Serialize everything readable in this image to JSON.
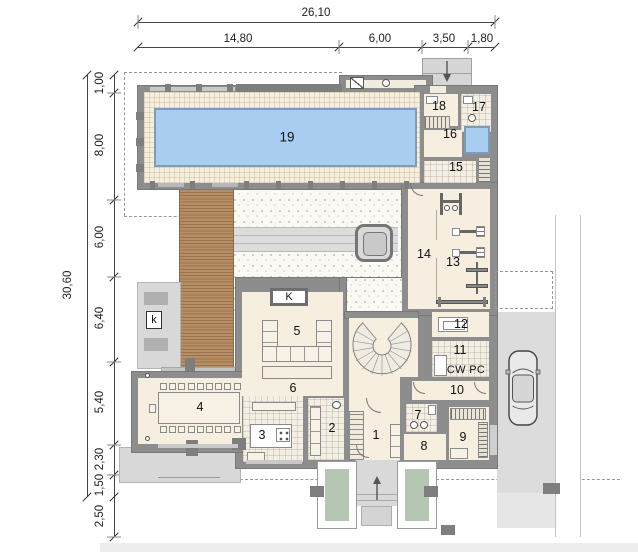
{
  "dimensions": {
    "top": {
      "total": "26,10",
      "segments": [
        "14,80",
        "6,00",
        "3,50",
        "1,80"
      ]
    },
    "left": {
      "total": "30,60",
      "segments": [
        "1,00",
        "8,00",
        "6,00",
        "6,40",
        "5,40",
        "2,30",
        "1,50",
        "2,50"
      ]
    }
  },
  "rooms": [
    "1",
    "2",
    "3",
    "4",
    "5",
    "6",
    "7",
    "8",
    "9",
    "10",
    "11",
    "12",
    "13",
    "14",
    "15",
    "16",
    "17",
    "18",
    "19"
  ],
  "labels": {
    "fireplace_indoor": "K",
    "fireplace_outdoor": "k",
    "laundry_appliances": "CW PC"
  },
  "icons": {
    "entry_top": "down-arrow",
    "entry_bottom": "up-arrow",
    "vehicle": "car-top-view",
    "stairs_spiral": "spiral-staircase",
    "stairs_straight": "straight-staircase"
  },
  "colors": {
    "wall": "#8d8d8d",
    "floor": "#f6eede",
    "pool_water": "#a8cdf0",
    "deck_wood": "#b2895f",
    "terrace": "#d8d8d8",
    "driveway": "#dcdcdc",
    "planter_green": "#b5c7b2",
    "dashed_line": "#999999"
  }
}
